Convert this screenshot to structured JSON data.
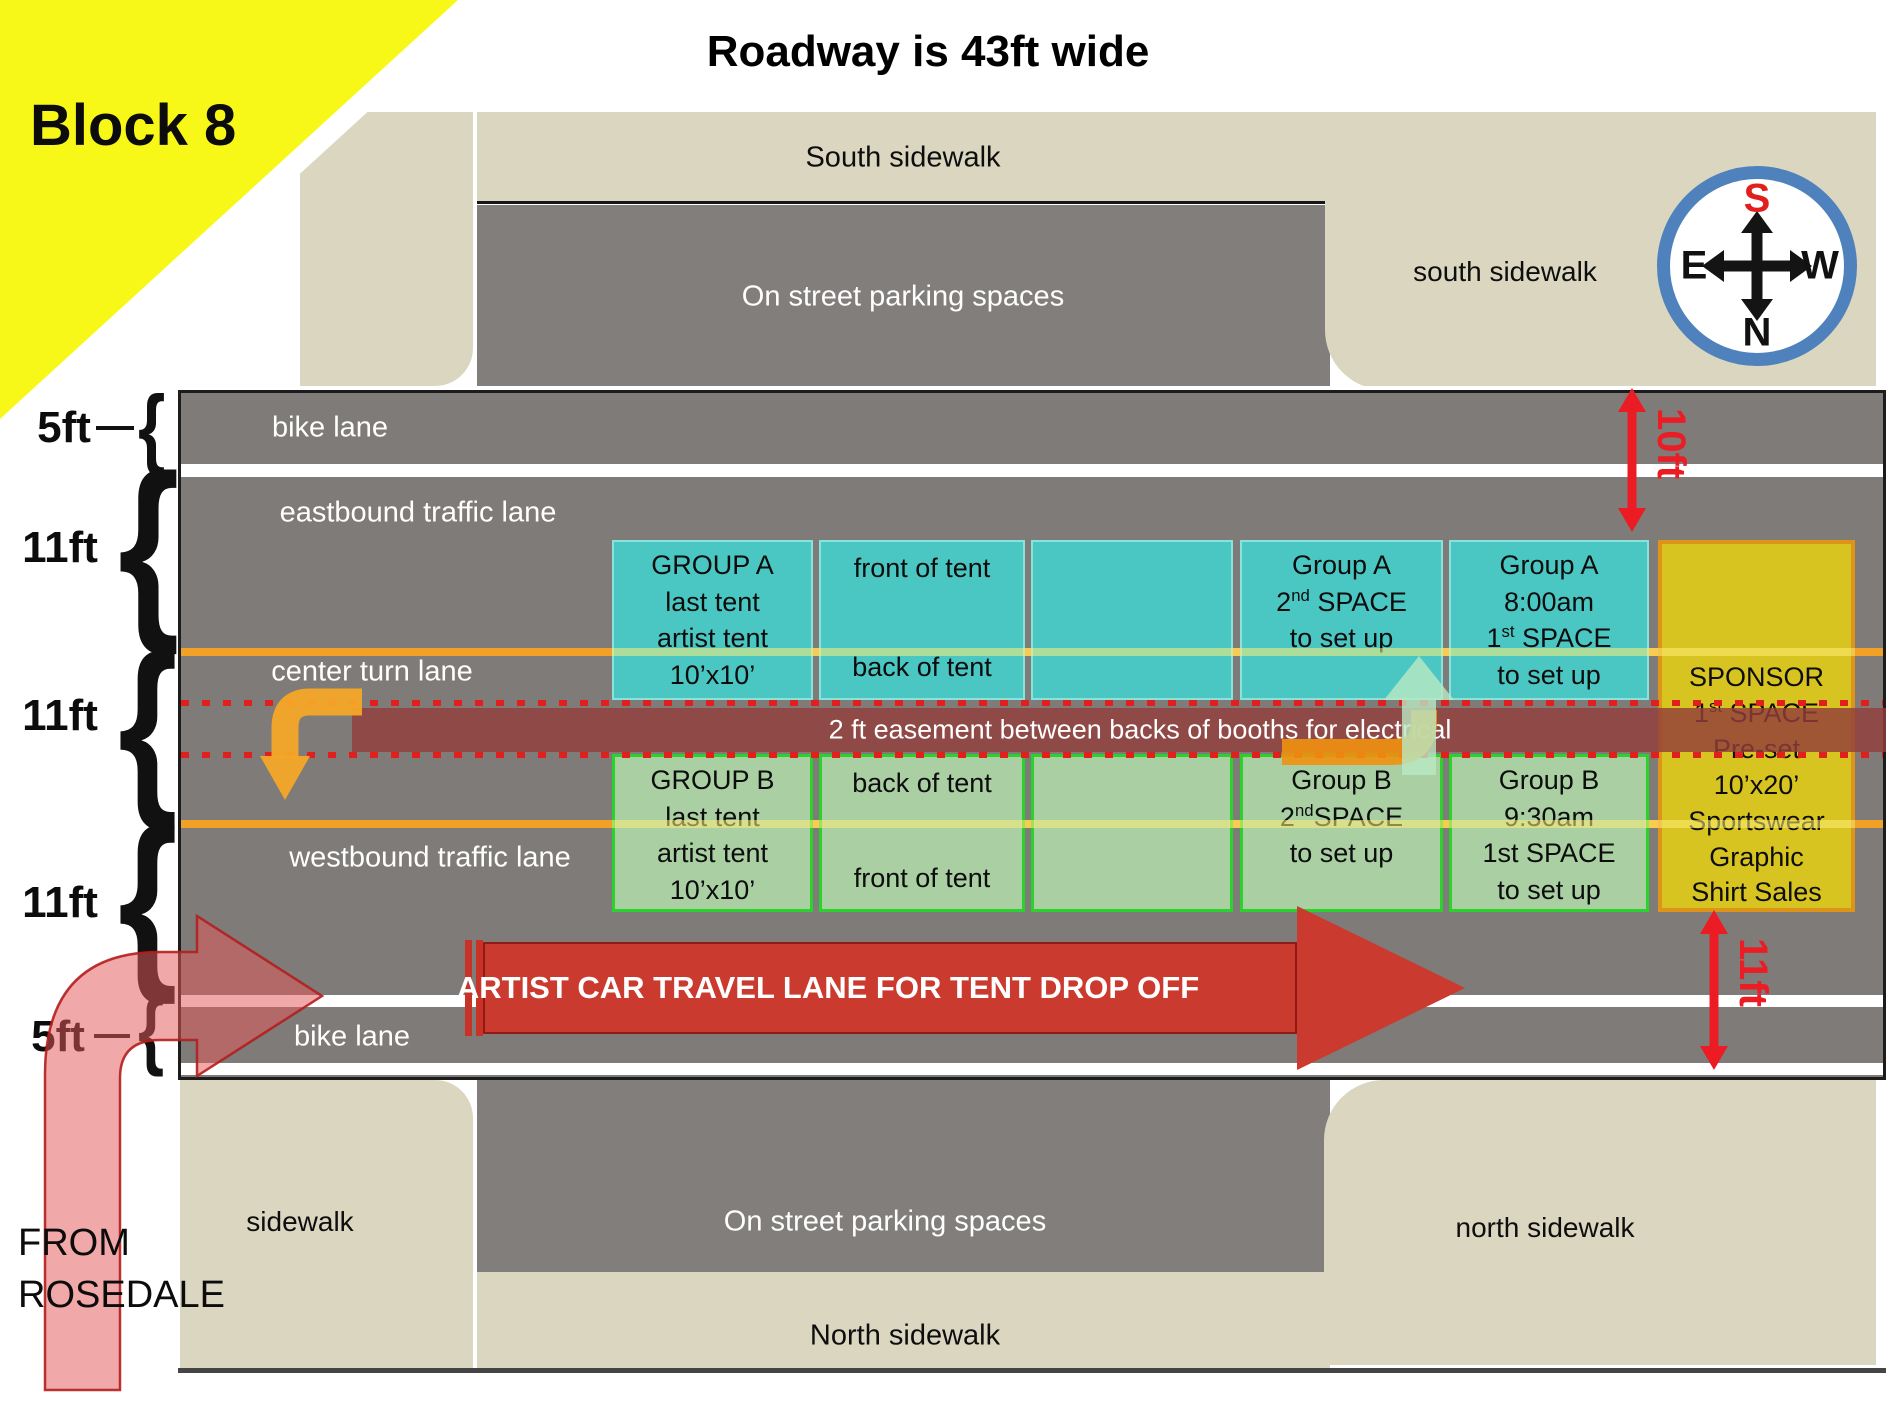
{
  "page": {
    "block_label": "Block 8",
    "title": "Roadway is 43ft wide"
  },
  "compass": {
    "s": "S",
    "n": "N",
    "e": "E",
    "w": "W"
  },
  "areas": {
    "south_sidewalk_band": "South sidewalk",
    "south_sidewalk_right": "south sidewalk",
    "parking_top": "On street parking spaces",
    "parking_bottom": "On street parking spaces",
    "sidewalk_left": "sidewalk",
    "north_sidewalk_band": "North sidewalk",
    "north_sidewalk_right": "north sidewalk"
  },
  "lanes": {
    "bike_south": "bike lane",
    "eastbound": "eastbound traffic lane",
    "center_turn": "center turn lane",
    "westbound": "westbound traffic lane",
    "bike_north": "bike lane"
  },
  "measurements": {
    "bike_south": "5ft",
    "eastbound": "11ft",
    "center_turn": "11ft",
    "westbound": "11ft",
    "bike_north": "5ft",
    "curb_to_booth": "10ft",
    "booth_to_curb": "11ft"
  },
  "easement_label": "2 ft easement between backs of booths for electrical",
  "artist_lane_label": "ARTIST CAR TRAVEL LANE FOR TENT DROP OFF",
  "from_rosedale": {
    "line1": "FROM",
    "line2": "ROSEDALE"
  },
  "booths": {
    "a1": {
      "lines": [
        "GROUP A",
        "last tent",
        "artist tent",
        "10’x10’"
      ]
    },
    "a2": {
      "top": "front of tent",
      "bottom": "back of tent"
    },
    "a3": {
      "lines": []
    },
    "a4": {
      "lines": [
        "Group A",
        "2^nd^ SPACE",
        "to set up"
      ]
    },
    "a5": {
      "lines": [
        "Group A",
        "8:00am",
        "1^st^ SPACE",
        "to set up"
      ]
    },
    "b1": {
      "lines": [
        "GROUP B",
        "last tent",
        "artist tent",
        "10’x10’"
      ]
    },
    "b2": {
      "top": "back of tent",
      "bottom": "front of tent"
    },
    "b3": {
      "lines": []
    },
    "b4": {
      "lines": [
        "Group B",
        "2^nd^SPACE",
        "to set up"
      ]
    },
    "b5": {
      "lines": [
        "Group B",
        "9:30am",
        "1st SPACE",
        "to set up"
      ]
    },
    "sponsor": {
      "lines": [
        "SPONSOR",
        "1^st^ SPACE",
        "Pre-set",
        "10’x20’",
        "Sportswear",
        "Graphic",
        "Shirt Sales"
      ]
    }
  },
  "icons": {
    "brace": "{"
  },
  "colors": {
    "highlight_yellow": "#F8F818",
    "sidewalk_cream": "#DBD6C0",
    "road_gray": "#7E7B78",
    "booth_teal": "#4BC7C3",
    "booth_green": "#A9CFA3",
    "booth_green_border": "#2BD22B",
    "sponsor_yellow": "#D7C420",
    "sponsor_border": "#DE9418",
    "lane_line_orange": "#F2A127",
    "easement_maroon": "#8F3E3C",
    "dimension_red": "#EC1C24",
    "artist_arrow_red": "#CB3A2E",
    "compass_ring_blue": "#4F81BD"
  }
}
